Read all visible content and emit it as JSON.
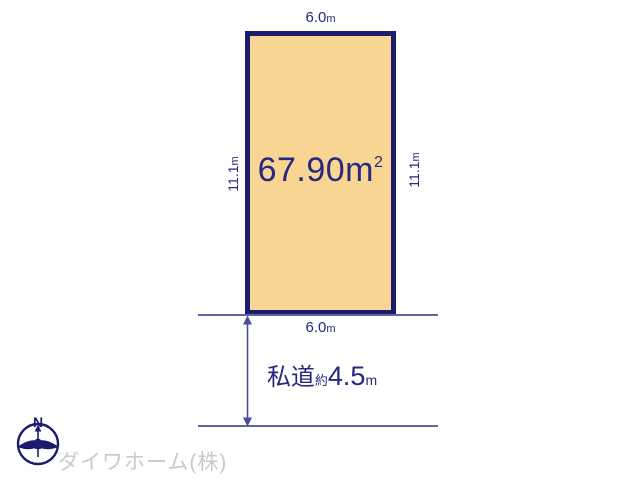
{
  "plot": {
    "area_value": "67.90",
    "area_unit": "m",
    "area_sup": "2",
    "top_width": "6.0",
    "bottom_width": "6.0",
    "left_depth": "11.1",
    "right_depth": "11.1",
    "unit": "m",
    "fill_color": "#f8d592",
    "border_color": "#1b1b70"
  },
  "road": {
    "label": "私道",
    "approx_prefix": "約",
    "width_value": "4.5",
    "unit": "m"
  },
  "compass": {
    "north": "N"
  },
  "footer": {
    "company": "ダイワホーム(株)",
    "text_color": "#c9c9c9"
  },
  "colors": {
    "dimension_text": "#28287e",
    "guide_line": "#63639e",
    "arrow": "#4b4b96"
  }
}
